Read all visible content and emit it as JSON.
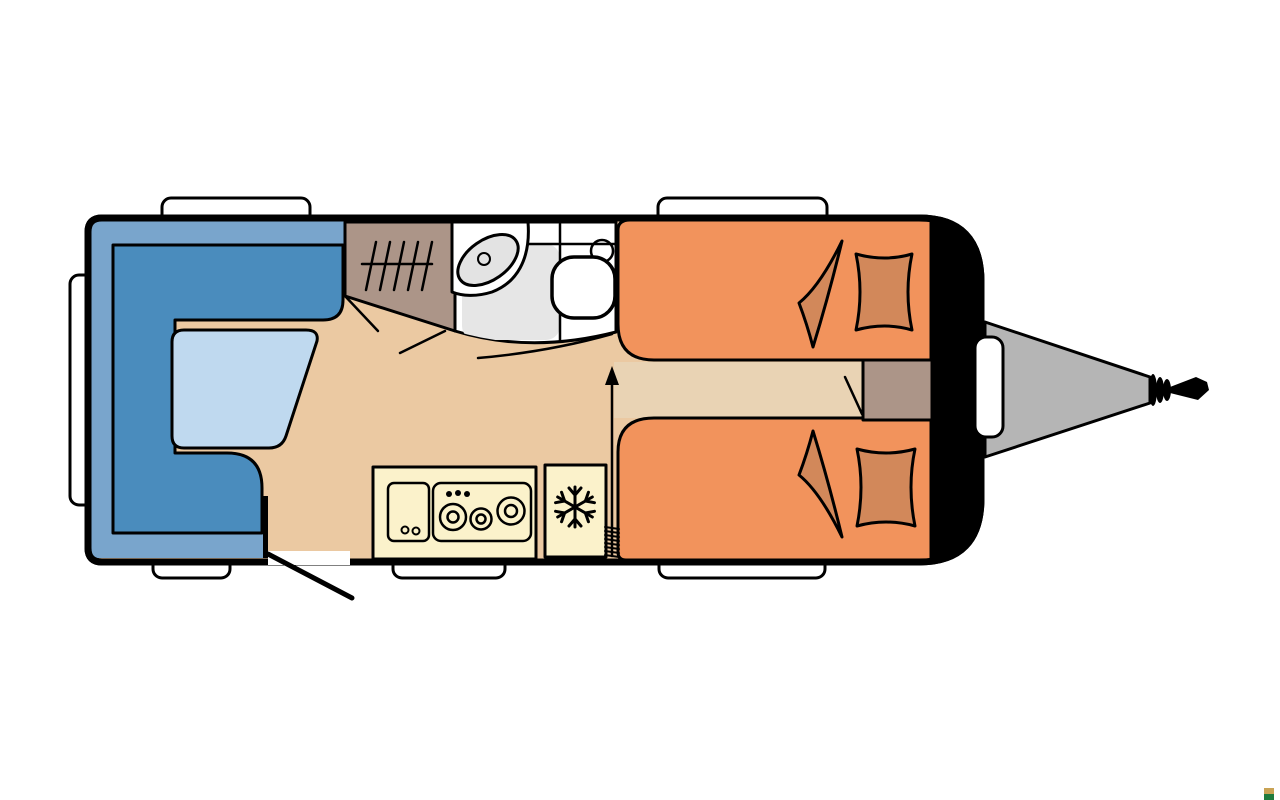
{
  "diagram": {
    "kind": "caravan-floorplan-top-view",
    "orientation": "hitch-on-right",
    "rooms": [
      {
        "name": "dinette-lounge",
        "position": "rear-left"
      },
      {
        "name": "wardrobe",
        "position": "center-top"
      },
      {
        "name": "washroom",
        "position": "center-top",
        "fixtures": [
          "washbasin",
          "shower-tray",
          "toilet"
        ]
      },
      {
        "name": "kitchen",
        "position": "center-bottom",
        "fixtures": [
          "sink",
          "three-burner-hob",
          "fridge"
        ]
      },
      {
        "name": "twin-single-beds",
        "position": "front-right"
      },
      {
        "name": "drawbar-hitch",
        "position": "front-exterior"
      }
    ],
    "symbols": [
      {
        "name": "entrance-door-swing",
        "position": "bottom-center-left"
      },
      {
        "name": "walkway-arrow",
        "position": "center"
      },
      {
        "name": "clothes-rail-hatching",
        "position": "wardrobe"
      },
      {
        "name": "heater-coil",
        "position": "between-fridge-and-bed"
      },
      {
        "name": "snowflake-fridge-icon",
        "position": "kitchen-fridge"
      },
      {
        "name": "pillow",
        "count": 2
      },
      {
        "name": "duvet-corner",
        "count": 2
      },
      {
        "name": "window",
        "count": 6
      }
    ]
  },
  "colors": {
    "background": "#FFFFFF",
    "wall": "#000000",
    "floor": "#EBC9A2",
    "walkway": "#E9D3B4",
    "seat_back": "#79A5CC",
    "seat_cushion": "#4A8CBD",
    "table": "#BFD9EF",
    "bed": "#F2935C",
    "bedding": "#D2885A",
    "wardrobe": "#AC9588",
    "bedside_cabinet": "#AC9588",
    "kitchen_unit": "#FBF2CB",
    "appliance_panel": "#FDFBE9",
    "bathroom_floor": "#FFFFFF",
    "shower_tray": "#E6E6E6",
    "washbasin": "#E3E3E3",
    "drawbar": "#B5B5B5",
    "gas_locker": "#B5B5B5",
    "window": "#FFFFFF",
    "watermark_top": "#C9A355",
    "watermark_bottom": "#1E7B3D"
  }
}
